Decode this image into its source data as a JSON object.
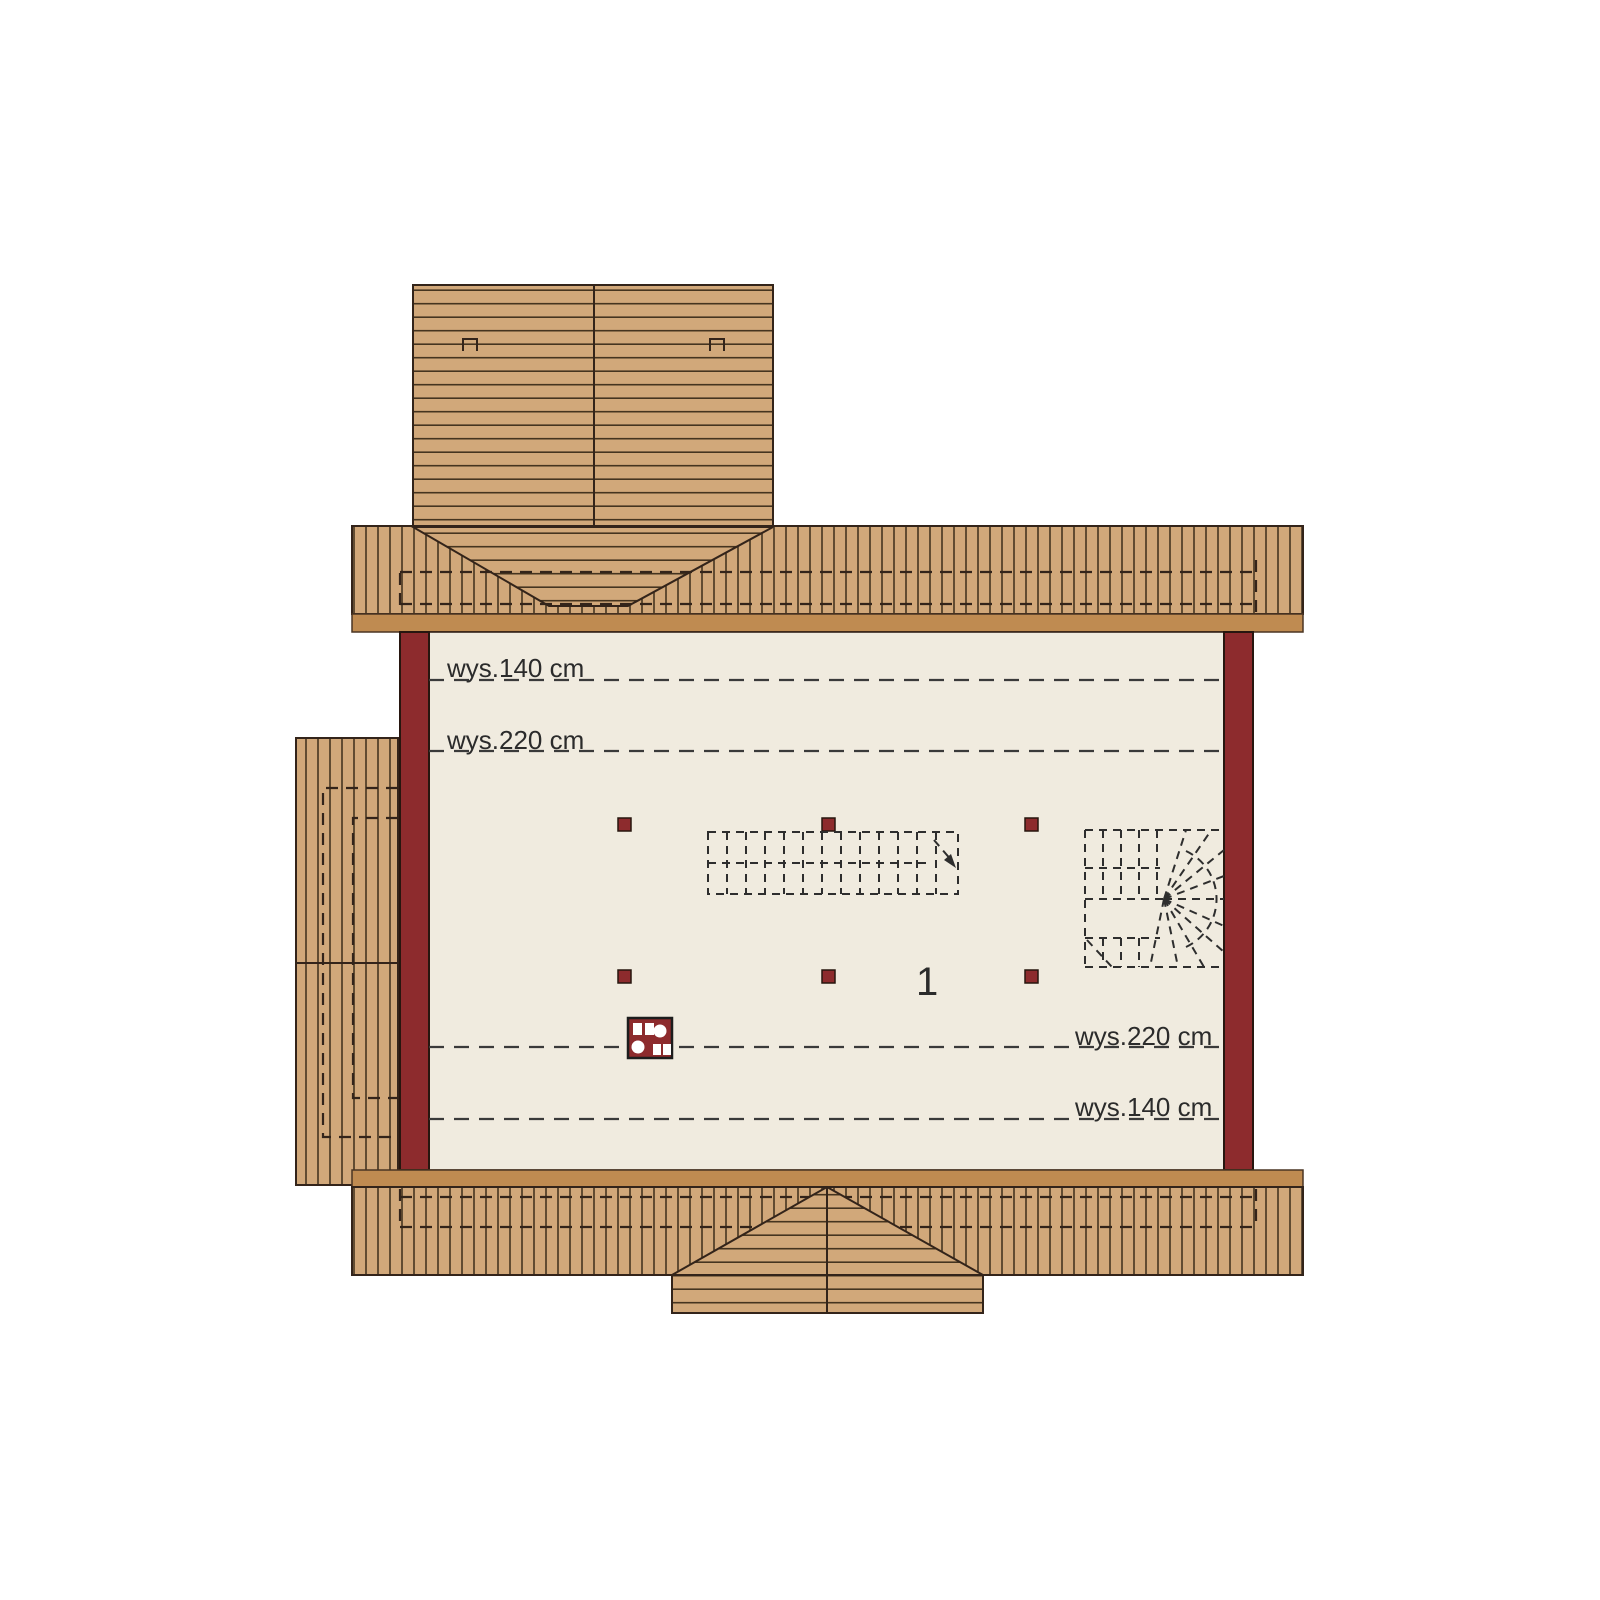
{
  "floor_plan": {
    "room_number": "1",
    "annotations": {
      "top_h140": "wys.140 cm",
      "top_h220": "wys.220 cm",
      "bottom_h220": "wys.220 cm",
      "bottom_h140": "wys.140 cm"
    },
    "colors": {
      "background": "#ffffff",
      "roof_plank": "#d1a87a",
      "roof_line": "#45341f",
      "eave_band": "#bf8b51",
      "wall": "#8d2b2d",
      "floor": "#f0ebdf",
      "annotation": "#2b2b2b"
    }
  }
}
